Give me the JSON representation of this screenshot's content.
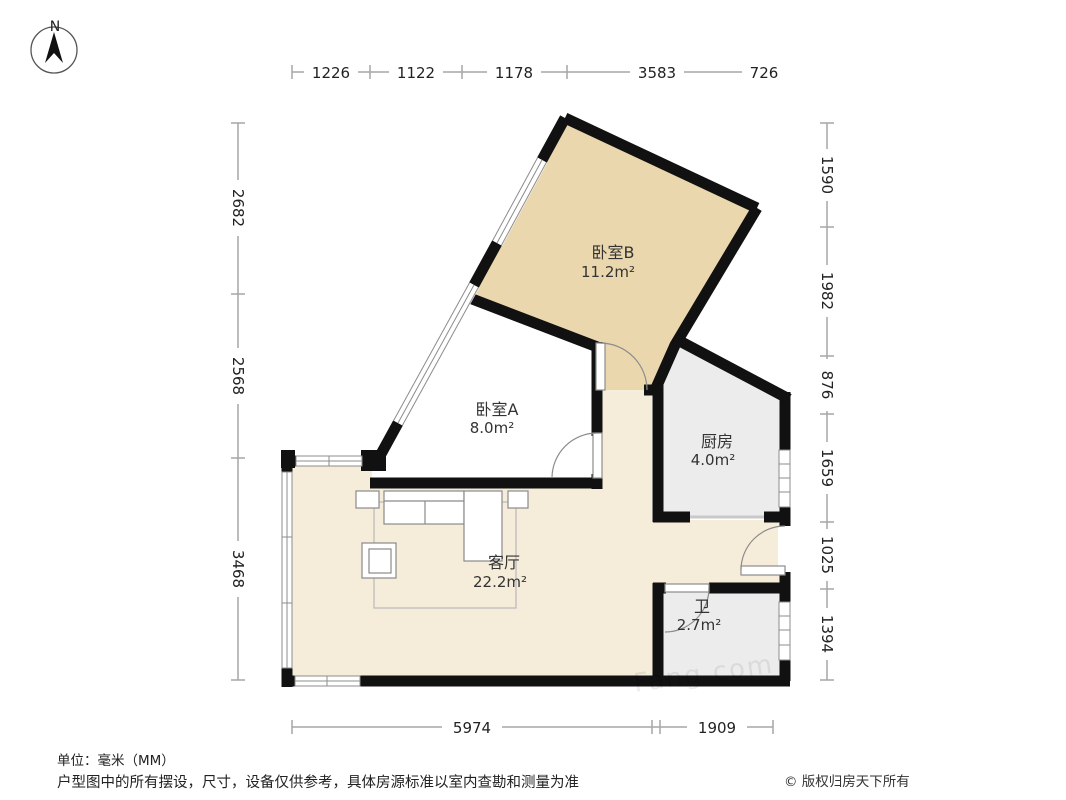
{
  "compass": {
    "label": "N"
  },
  "rooms": {
    "bedroomB": {
      "name": "卧室B",
      "area": "11.2m²"
    },
    "bedroomA": {
      "name": "卧室A",
      "area": "8.0m²"
    },
    "kitchen": {
      "name": "厨房",
      "area": "4.0m²"
    },
    "living": {
      "name": "客厅",
      "area": "22.2m²"
    },
    "bath": {
      "name": "卫",
      "area": "2.7m²"
    }
  },
  "dimensions": {
    "top": [
      "1226",
      "1122",
      "1178",
      "3583",
      "726"
    ],
    "left": [
      "2682",
      "2568",
      "3468"
    ],
    "right": [
      "1590",
      "1982",
      "876",
      "1659",
      "1025",
      "1394"
    ],
    "bottom": [
      "5974",
      "1909"
    ]
  },
  "footer": {
    "unit": "单位：毫米（MM）",
    "disclaimer": "户型图中的所有摆设，尺寸，设备仅供参考，具体房源标准以室内查勘和测量为准",
    "copyright": "© 版权归房天下所有"
  },
  "watermark": "Fang.com",
  "colors": {
    "wall": "#111111",
    "bedroom_b_fill": "#ead7ae",
    "bedroom_a_fill": "#ffffff",
    "living_fill": "#f5ecda",
    "kitchen_fill": "#ececec",
    "bath_fill": "#ececec",
    "dim_line": "#a6a6a6",
    "furniture_line": "#8a8a8a"
  }
}
